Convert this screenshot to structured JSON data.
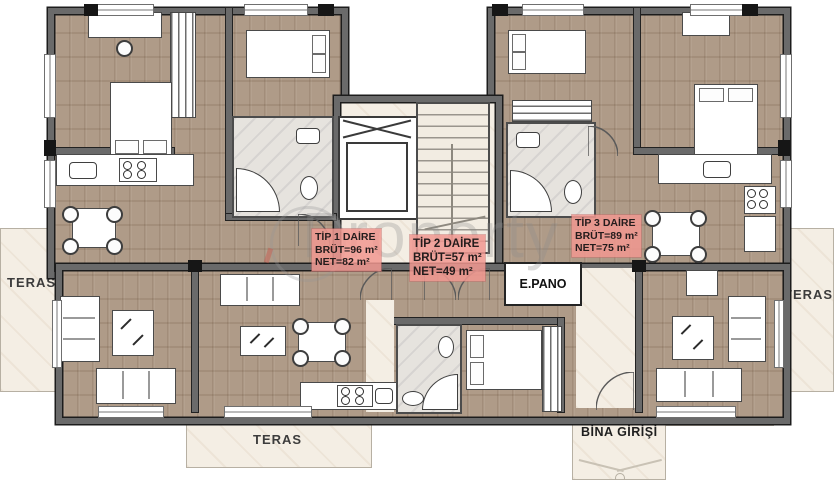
{
  "watermark": {
    "text": "Property"
  },
  "apartments": [
    {
      "name": "TİP 1 DAİRE",
      "brut": "BRÜT=96 m²",
      "net": "NET=82 m²"
    },
    {
      "name": "TİP 2 DAİRE",
      "brut": "BRÜT=57 m²",
      "net": "NET=49 m²"
    },
    {
      "name": "TİP 3 DAİRE",
      "brut": "BRÜT=89 m²",
      "net": "NET=75 m²"
    }
  ],
  "labels": {
    "teras_left": "TERAS",
    "teras_right": "TERAS",
    "teras_bottom": "TERAS",
    "epano": "E.PANO",
    "entrance": "BİNA GİRİŞİ"
  },
  "colors": {
    "wall": "#6a6a6a",
    "wall_outline": "#1c1c1c",
    "wood_floor": "#ab9682",
    "marble_floor": "#f4eee4",
    "bath_tile": "#e6e3de",
    "apartment_label_bg": "#f1988f",
    "label_text": "#241c1c"
  }
}
